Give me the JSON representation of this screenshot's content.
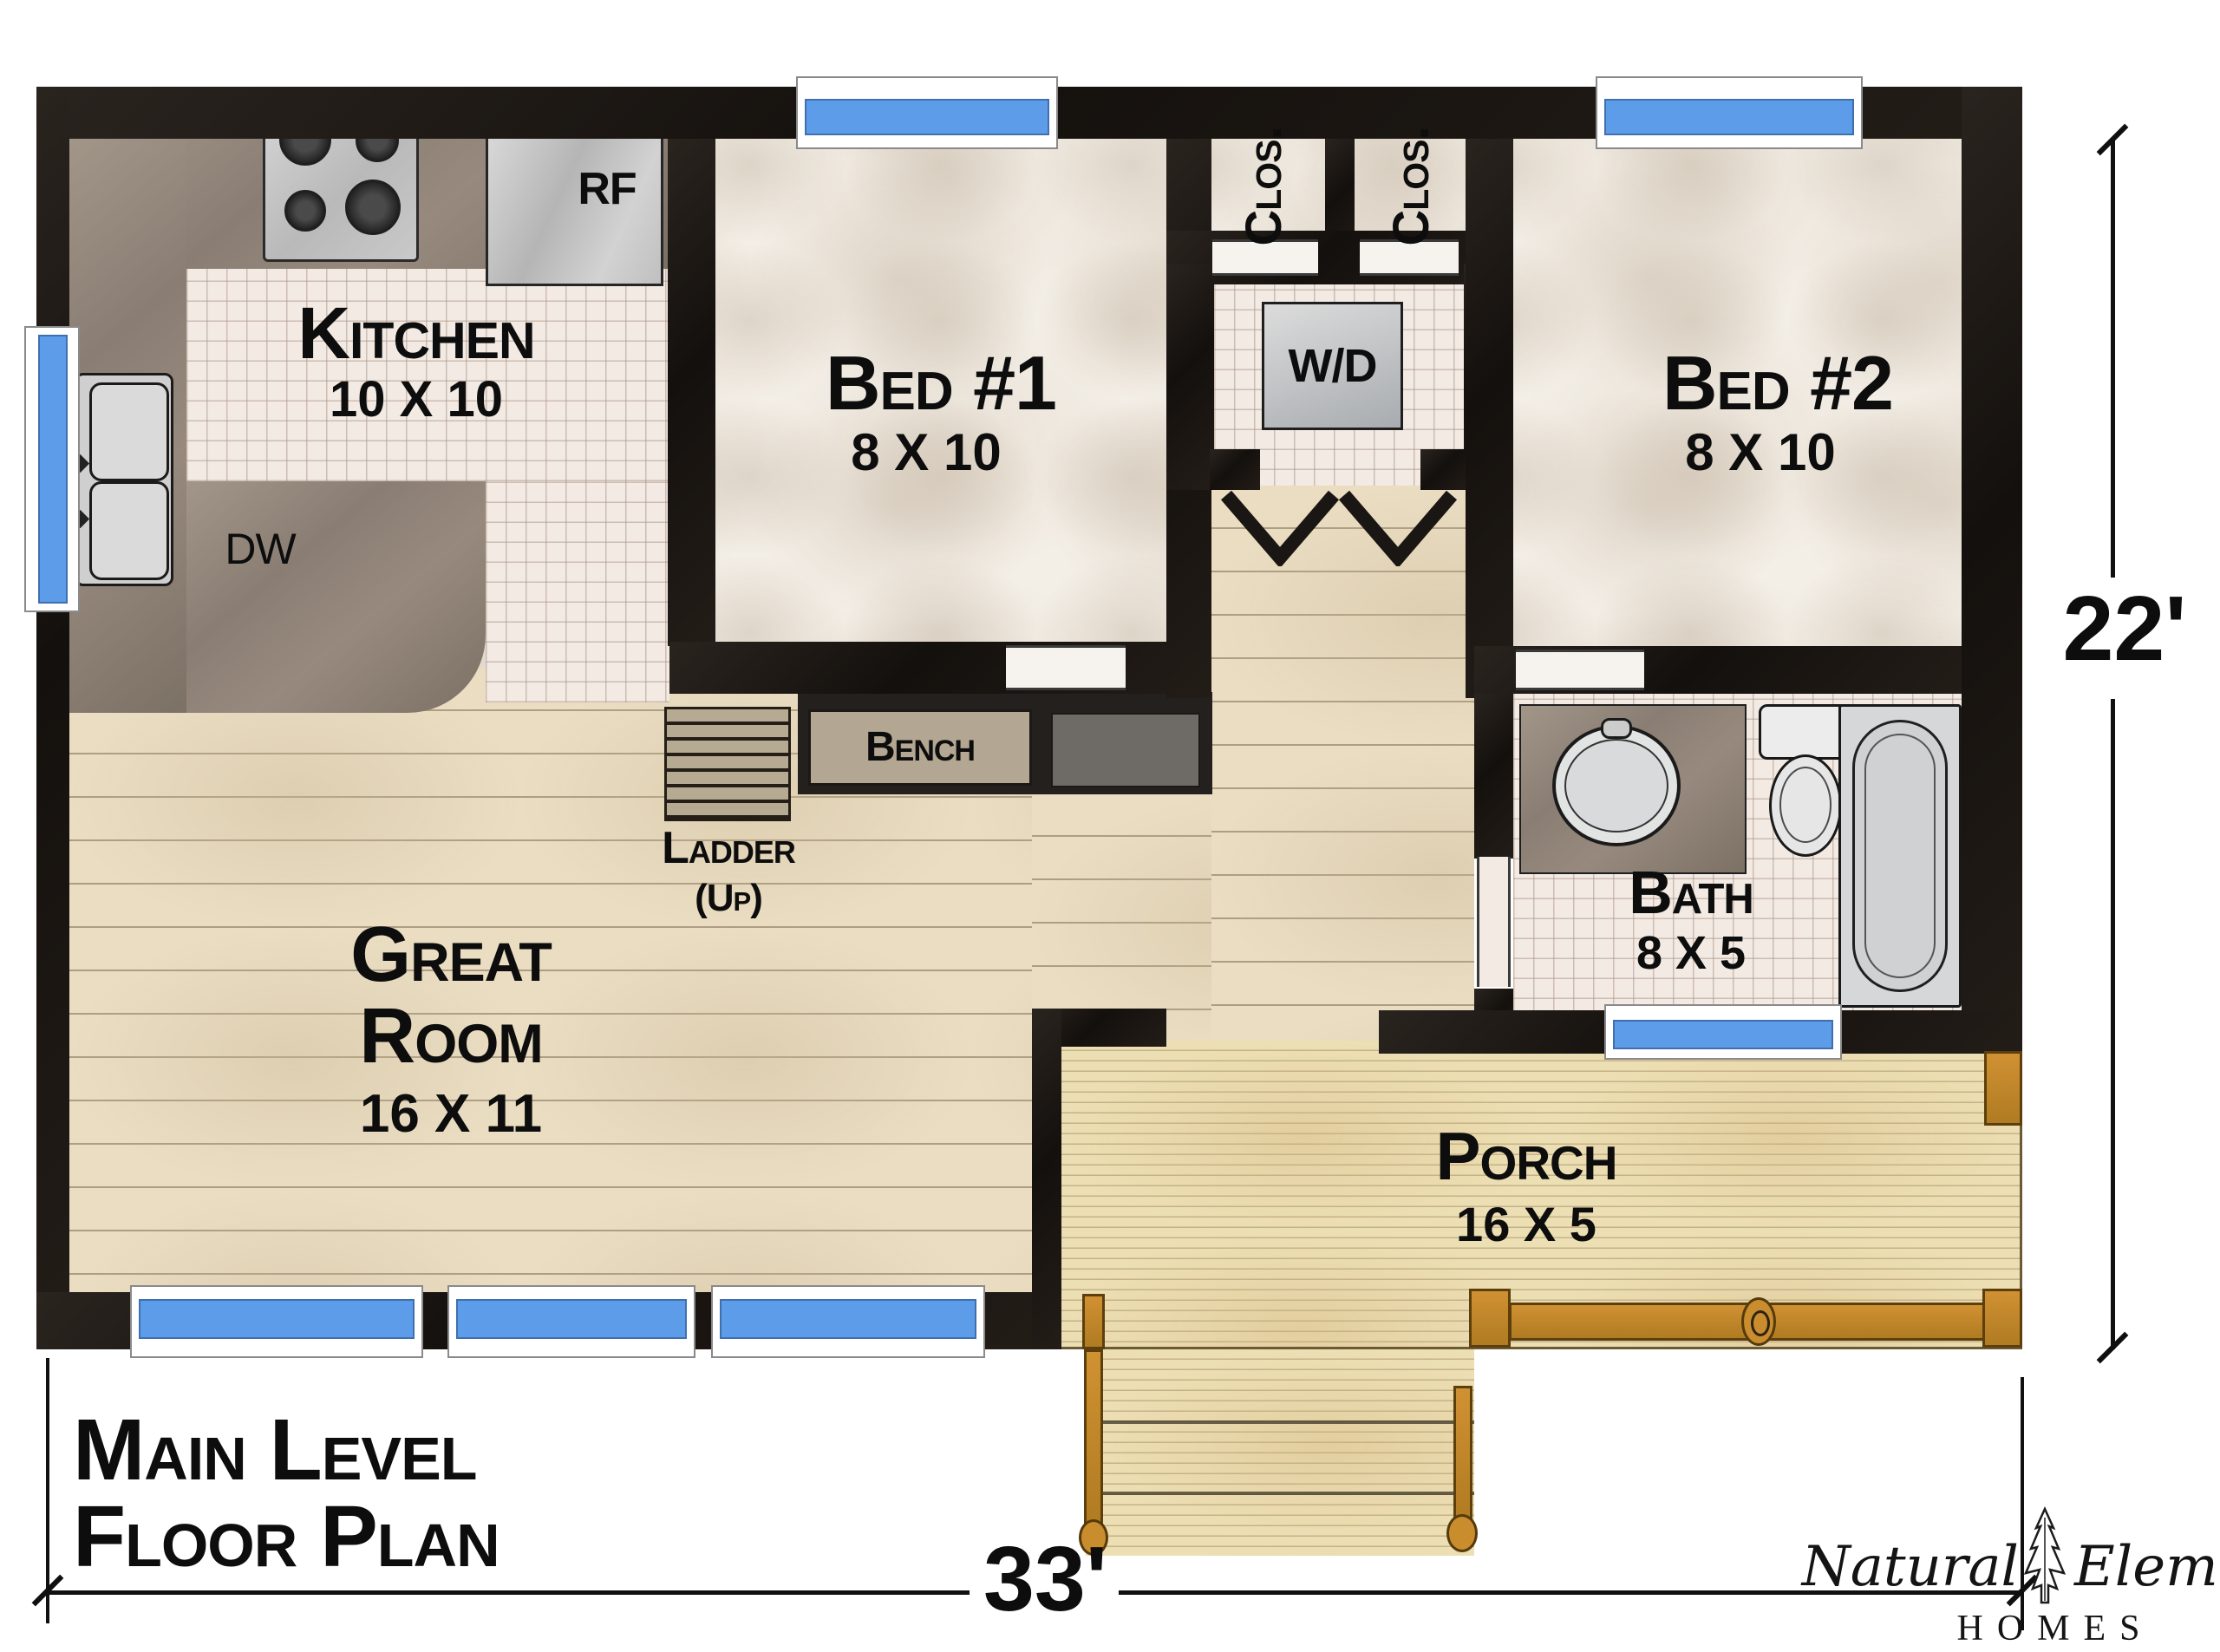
{
  "title": {
    "line1": "Main Level",
    "line2": "Floor Plan"
  },
  "dims": {
    "width_label": "33'",
    "height_label": "22'"
  },
  "rooms": {
    "kitchen": {
      "name": "Kitchen",
      "size": "10 X 10"
    },
    "bed1": {
      "name": "Bed #1",
      "size": "8 X 10"
    },
    "bed2": {
      "name": "Bed #2",
      "size": "8 X 10"
    },
    "great": {
      "line1": "Great",
      "line2": "Room",
      "size": "16 X 11"
    },
    "bath": {
      "name": "Bath",
      "size": "8 X 5"
    },
    "porch": {
      "name": "Porch",
      "size": "16 X 5"
    },
    "closet1": {
      "name": "Clos."
    },
    "closet2": {
      "name": "Clos."
    }
  },
  "features": {
    "washer_dryer": "W/D",
    "refrigerator": "RF",
    "dishwasher": "DW",
    "bench": "Bench",
    "ladder": "Ladder",
    "ladder_dir": "(Up)"
  },
  "logo": {
    "word1": "Natural",
    "word2": "Element",
    "word3": "HOMES"
  },
  "colors": {
    "wall": "#17120f",
    "window_glass": "#5d9ce9",
    "wood_floor": "#eaddc2",
    "deck": "#eddfb4",
    "tile": "#f2eae3",
    "counter": "#8d8177",
    "porch_wood": "#c28a2f",
    "text": "#0e0e0e"
  }
}
